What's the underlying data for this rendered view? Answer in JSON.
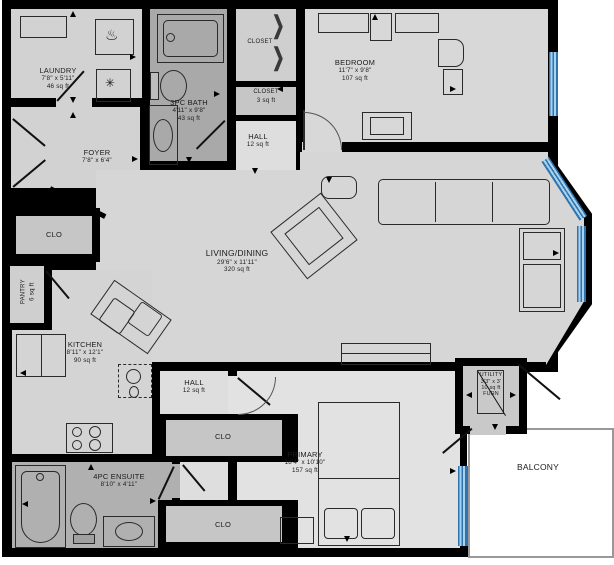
{
  "colors": {
    "wall": "#000000",
    "floor": "#d6d6d6",
    "floorLight": "#e2e2e2",
    "wet": "#a9a9a9",
    "ensuiteFill": "#b0b0b0",
    "closetFill": "#c6c6c6",
    "hallFill": "#dedede",
    "windowBlue": "#2f74b0",
    "windowLight": "#a8d2ec",
    "balconyBorder": "#999999"
  },
  "icons": {
    "dryer": "♨",
    "washer": "✳",
    "chevron": "❯"
  },
  "rooms": {
    "laundry": {
      "name": "LAUNDRY",
      "dims": "7'8\" x 5'11\"",
      "area": "46 sq ft"
    },
    "bath": {
      "name": "3PC BATH",
      "dims": "4'11\" x 9'8\"",
      "area": "43 sq ft"
    },
    "closet_top": {
      "name": "CLOSET"
    },
    "closet_small": {
      "name": "CLOSET",
      "area": "3 sq ft"
    },
    "bedroom": {
      "name": "BEDROOM",
      "dims": "11'7\" x 9'8\"",
      "area": "107 sq ft"
    },
    "hall_upper": {
      "name": "HALL",
      "area": "12 sq ft"
    },
    "foyer": {
      "name": "FOYER",
      "dims": "7'8\" x 6'4\""
    },
    "clo_left": {
      "name": "CLO"
    },
    "pantry": {
      "name": "PANTRY",
      "area": "6 sq ft"
    },
    "living": {
      "name": "LIVING/DINING",
      "dims": "29'6\" x 11'11\"",
      "area": "320 sq ft"
    },
    "kitchen": {
      "name": "KITCHEN",
      "dims": "8'11\" x 12'1\"",
      "area": "90 sq ft"
    },
    "hall_lower": {
      "name": "HALL",
      "area": "12 sq ft"
    },
    "clo_mid": {
      "name": "CLO"
    },
    "clo_bottom": {
      "name": "CLO"
    },
    "primary": {
      "name": "PRIMARY",
      "dims": "18'4\" x 10'10\"",
      "area": "157 sq ft"
    },
    "ensuite": {
      "name": "4PC ENSUITE",
      "dims": "8'10\" x 4'11\""
    },
    "utility": {
      "name": "UTILITY",
      "dims": "3'3\" x 3'",
      "area": "10 sq ft",
      "appliance": "FURN"
    },
    "balcony": {
      "name": "BALCONY"
    }
  }
}
